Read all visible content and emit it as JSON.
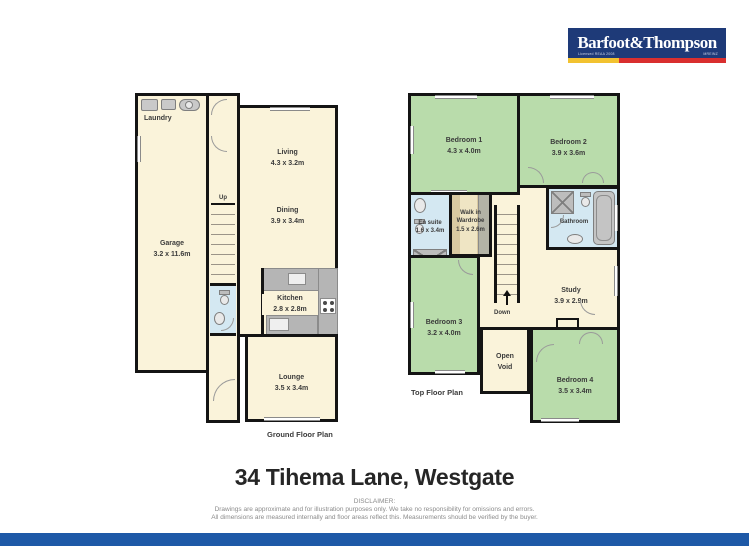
{
  "logo": {
    "part1": "Barfoot",
    "amp": "&",
    "part2": "Thompson",
    "sub_left": "Licensed REAA 2008",
    "sub_right": "MREINZ",
    "navy": "#1e3a78",
    "yellow": "#f2c230",
    "red": "#d92f2f"
  },
  "title": "34 Tihema Lane, Westgate",
  "disclaimer": {
    "heading": "DISCLAIMER:",
    "line1": "Drawings are approximate and for illustration purposes only. We take no responsibility for omissions and errors.",
    "line2": "All dimensions are measured internally and floor areas reflect this. Measurements should be verified by the buyer."
  },
  "ground_floor": {
    "caption": "Ground Floor Plan",
    "stairs_label": "Up",
    "rooms": {
      "laundry": {
        "name": "Laundry"
      },
      "garage": {
        "name": "Garage",
        "dims": "3.2 x 11.6m"
      },
      "living": {
        "name": "Living",
        "dims": "4.3 x 3.2m"
      },
      "dining": {
        "name": "Dining",
        "dims": "3.9 x 3.4m"
      },
      "kitchen": {
        "name": "Kitchen",
        "dims": "2.8 x 2.8m"
      },
      "lounge": {
        "name": "Lounge",
        "dims": "3.5 x 3.4m"
      }
    }
  },
  "top_floor": {
    "caption": "Top Floor Plan",
    "stairs_label": "Down",
    "rooms": {
      "bedroom1": {
        "name": "Bedroom 1",
        "dims": "4.3 x 4.0m"
      },
      "bedroom2": {
        "name": "Bedroom 2",
        "dims": "3.9 x 3.6m"
      },
      "ensuite": {
        "name": "En suite",
        "dims": "1.6 x 3.4m"
      },
      "wardrobe": {
        "name1": "Walk in",
        "name2": "Wardrobe",
        "dims": "1.5 x 2.6m"
      },
      "bathroom": {
        "name": "Bathroom"
      },
      "study": {
        "name": "Study",
        "dims": "3.9 x 2.9m"
      },
      "bedroom3": {
        "name": "Bedroom 3",
        "dims": "3.2 x 4.0m"
      },
      "open_void": {
        "name1": "Open",
        "name2": "Void"
      },
      "bedroom4": {
        "name": "Bedroom 4",
        "dims": "3.5 x 3.4m"
      }
    }
  },
  "colors": {
    "wall": "#141414",
    "floor_cream": "#faf3da",
    "floor_green": "#b9dcab",
    "floor_blue": "#d4e8f2",
    "wardrobe_tan": "#d9c9a1",
    "fixture_gray": "#b5b5b5",
    "footer_bar_blue": "#1e59a7"
  }
}
